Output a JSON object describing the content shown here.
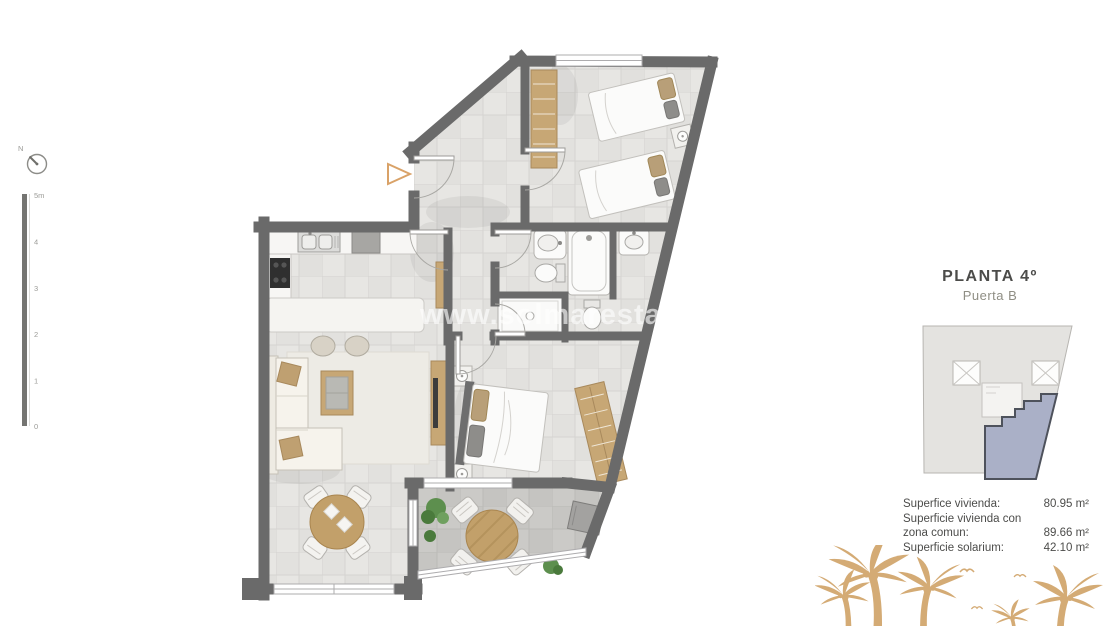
{
  "panel": {
    "title": "PLANTA 4º",
    "subtitle": "Puerta B"
  },
  "areas": {
    "rows": [
      {
        "label": "Superfice vivienda:",
        "value": "80.95 m²"
      },
      {
        "label": "Superficie vivienda con zona comun:",
        "value": "89.66 m²"
      },
      {
        "label": "Superficie solarium:",
        "value": "42.10 m²"
      }
    ]
  },
  "watermark": {
    "text": "www.solmarestates.co"
  },
  "compass": {
    "label": "N"
  },
  "scalebar": {
    "labels": [
      "5m",
      "4",
      "3",
      "2",
      "1",
      "0"
    ]
  },
  "colors": {
    "wall": "#6a6a6a",
    "wood": "#c7a775",
    "keyplan_highlight": "#aab0c7",
    "palm": "#d4ab75",
    "accent_marker": "#d9a268"
  }
}
